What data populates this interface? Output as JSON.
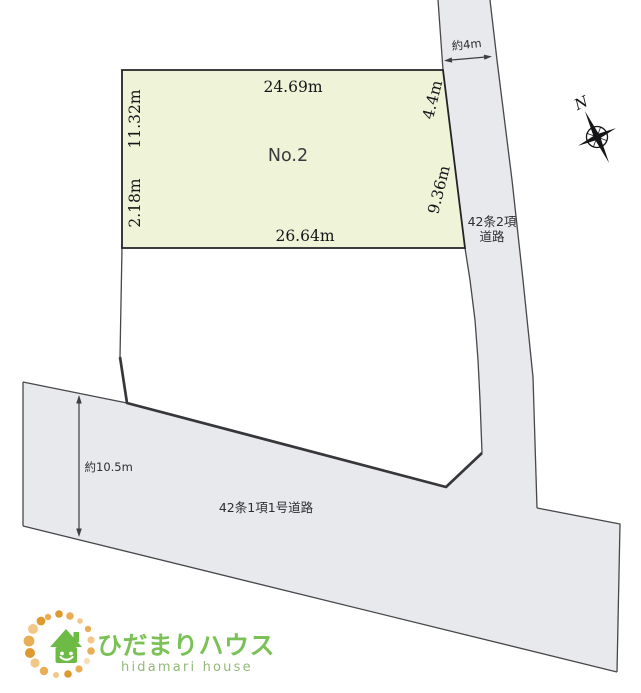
{
  "plot": {
    "name": "No.2",
    "dim_top": "24.69m",
    "dim_left_upper": "11.32m",
    "dim_left_lower": "2.18m",
    "dim_bottom": "26.64m",
    "dim_right_upper": "4.4m",
    "dim_right_lower": "9.36m"
  },
  "roads": {
    "east": {
      "label_line1": "42条2項",
      "label_line2": "道路",
      "width": "約4m"
    },
    "south": {
      "label": "42条1項1号道路",
      "width": "約10.5m"
    }
  },
  "compass": {
    "north_label": "N"
  },
  "logo": {
    "name_jp": "ひだまりハウス",
    "name_en": "hidamari house"
  },
  "colors": {
    "plot_fill": "#eff3d8",
    "road_fill": "#e8e9ed",
    "line": "#3e3e43",
    "brand_green": "#7cc158",
    "brand_green_muted": "#93b878"
  }
}
